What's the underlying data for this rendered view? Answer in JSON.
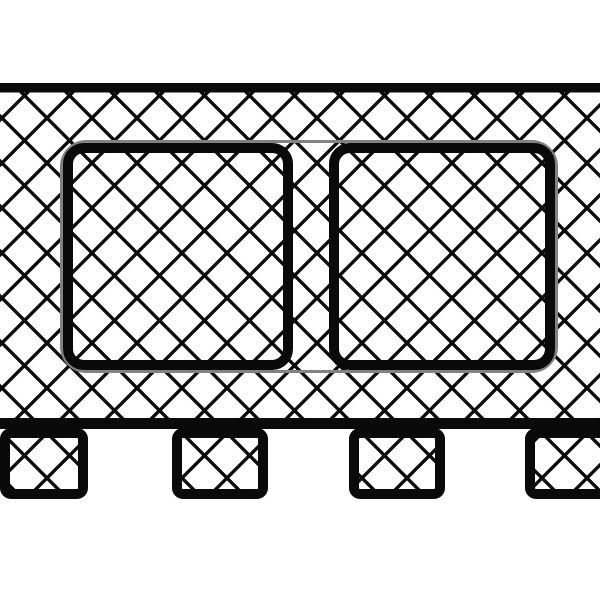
{
  "meta": {
    "description": "Black-and-white technical cross-section drawing: a wide diamond-crosshatched deck slab with two rounded-square cutout outlines joined by a thin gray frame, a thick top and bottom edge, and four crosshatched support feet along the bottom",
    "text_content": "none — the drawing contains no visible text, labels, or numbers"
  },
  "canvas": {
    "width": 600,
    "height": 600,
    "background": "#ffffff"
  },
  "palette": {
    "ink": "#0a0a0a",
    "paper": "#ffffff",
    "frame_gray": "#828282"
  },
  "hatch": {
    "pattern": "diamond-crosshatch-45deg",
    "cell": 45,
    "line_width": 3.4,
    "offset_x": 24.5,
    "offset_y": 5.5
  },
  "shapes": [
    {
      "name": "deck-hatch-fill",
      "type": "rect",
      "x": 0,
      "y": 92,
      "w": 600,
      "h": 327,
      "fill": "hatch",
      "stroke": "none",
      "stroke_width": 0,
      "rx": 0
    },
    {
      "name": "deck-top-edge",
      "type": "rect",
      "x": 0,
      "y": 83,
      "w": 600,
      "h": 9.5,
      "fill": "ink",
      "stroke": "none",
      "stroke_width": 0,
      "rx": 0
    },
    {
      "name": "deck-bottom-edge",
      "type": "rect",
      "x": 0,
      "y": 418,
      "w": 600,
      "h": 11,
      "fill": "ink",
      "stroke": "none",
      "stroke_width": 0,
      "rx": 0
    },
    {
      "name": "foot-1",
      "type": "rect",
      "x": 5,
      "y": 433,
      "w": 78,
      "h": 61,
      "fill": "hatch",
      "stroke": "ink",
      "stroke_width": 10,
      "rx": 6
    },
    {
      "name": "foot-2",
      "type": "rect",
      "x": 177,
      "y": 433,
      "w": 86,
      "h": 61,
      "fill": "hatch",
      "stroke": "ink",
      "stroke_width": 10,
      "rx": 6
    },
    {
      "name": "foot-3",
      "type": "rect",
      "x": 354,
      "y": 433,
      "w": 86,
      "h": 61,
      "fill": "hatch",
      "stroke": "ink",
      "stroke_width": 10,
      "rx": 6
    },
    {
      "name": "foot-4",
      "type": "rect",
      "x": 530,
      "y": 433,
      "w": 78,
      "h": 61,
      "fill": "hatch",
      "stroke": "ink",
      "stroke_width": 10,
      "rx": 6
    },
    {
      "name": "cutout-frame-outline",
      "type": "rect",
      "x": 61.5,
      "y": 141.5,
      "w": 495,
      "h": 230,
      "fill": "none",
      "stroke": "frame_gray",
      "stroke_width": 3,
      "rx": 25
    },
    {
      "name": "left-cutout",
      "type": "rect",
      "x": 68,
      "y": 148,
      "w": 220,
      "h": 217,
      "fill": "none",
      "stroke": "ink",
      "stroke_width": 10,
      "rx": 16
    },
    {
      "name": "right-cutout",
      "type": "rect",
      "x": 334,
      "y": 148,
      "w": 216,
      "h": 217,
      "fill": "none",
      "stroke": "ink",
      "stroke_width": 10,
      "rx": 16
    }
  ]
}
